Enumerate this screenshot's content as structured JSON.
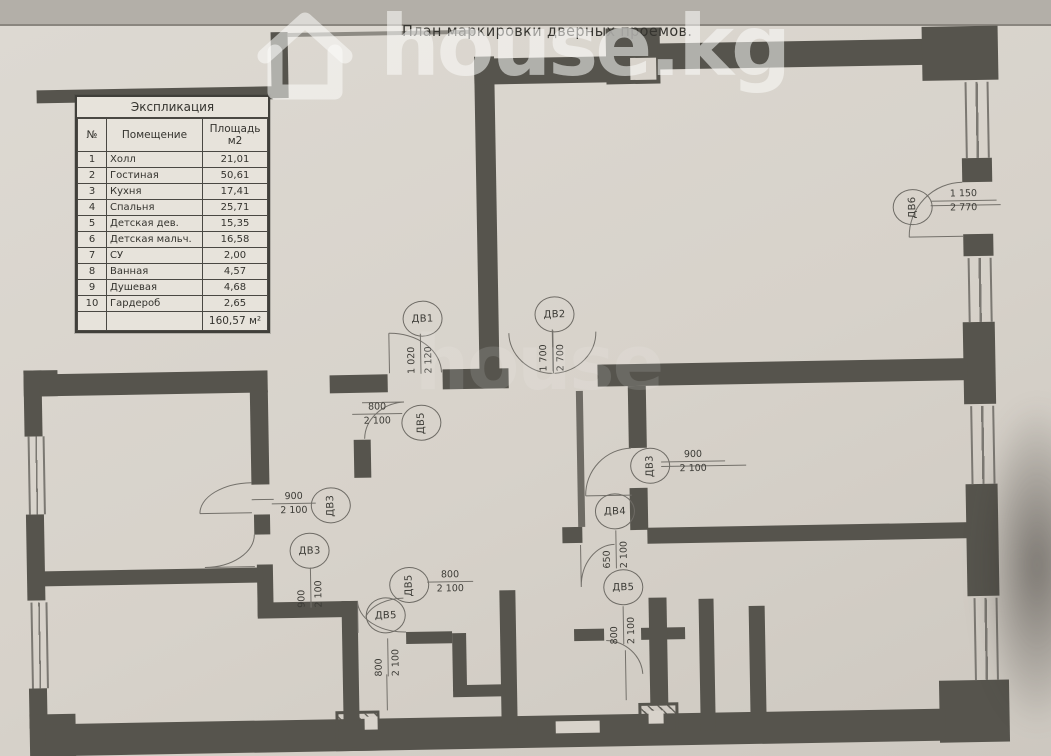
{
  "title": "План маркировки дверных проемов.",
  "watermark": {
    "brand": "house.kg",
    "echo": "house"
  },
  "table": {
    "title": "Экспликация",
    "columns": [
      "№",
      "Помещение",
      "Площадь м2"
    ],
    "rows": [
      [
        "1",
        "Холл",
        "21,01"
      ],
      [
        "2",
        "Гостиная",
        "50,61"
      ],
      [
        "3",
        "Кухня",
        "17,41"
      ],
      [
        "4",
        "Спальня",
        "25,71"
      ],
      [
        "5",
        "Детская дев.",
        "15,35"
      ],
      [
        "6",
        "Детская мальч.",
        "16,58"
      ],
      [
        "7",
        "СУ",
        "2,00"
      ],
      [
        "8",
        "Ванная",
        "4,57"
      ],
      [
        "9",
        "Душевая",
        "4,68"
      ],
      [
        "10",
        "Гардероб",
        "2,65"
      ]
    ],
    "total": "160,57 м²"
  },
  "door_marks": [
    {
      "label": "ДВ1",
      "w": "1 020",
      "h": "2 120"
    },
    {
      "label": "ДВ2",
      "w": "1 700",
      "h": "2 700"
    },
    {
      "label": "ДВ5",
      "w": "800",
      "h": "2 100"
    },
    {
      "label": "ДВ6",
      "w": "1 150",
      "h": "2 770"
    },
    {
      "label": "ДВ3",
      "w": "900",
      "h": "2 100"
    },
    {
      "label": "ДВ3",
      "w": "900",
      "h": "2 100"
    },
    {
      "label": "ДВ3",
      "w": "900",
      "h": "2 100"
    },
    {
      "label": "ДВ4",
      "w": "650",
      "h": "2 100"
    },
    {
      "label": "ДВ5",
      "w": "800",
      "h": "2 100"
    },
    {
      "label": "ДВ5",
      "w": "800",
      "h": "2 100"
    },
    {
      "label": "ДВ5",
      "w": "800",
      "h": "2 100"
    }
  ]
}
